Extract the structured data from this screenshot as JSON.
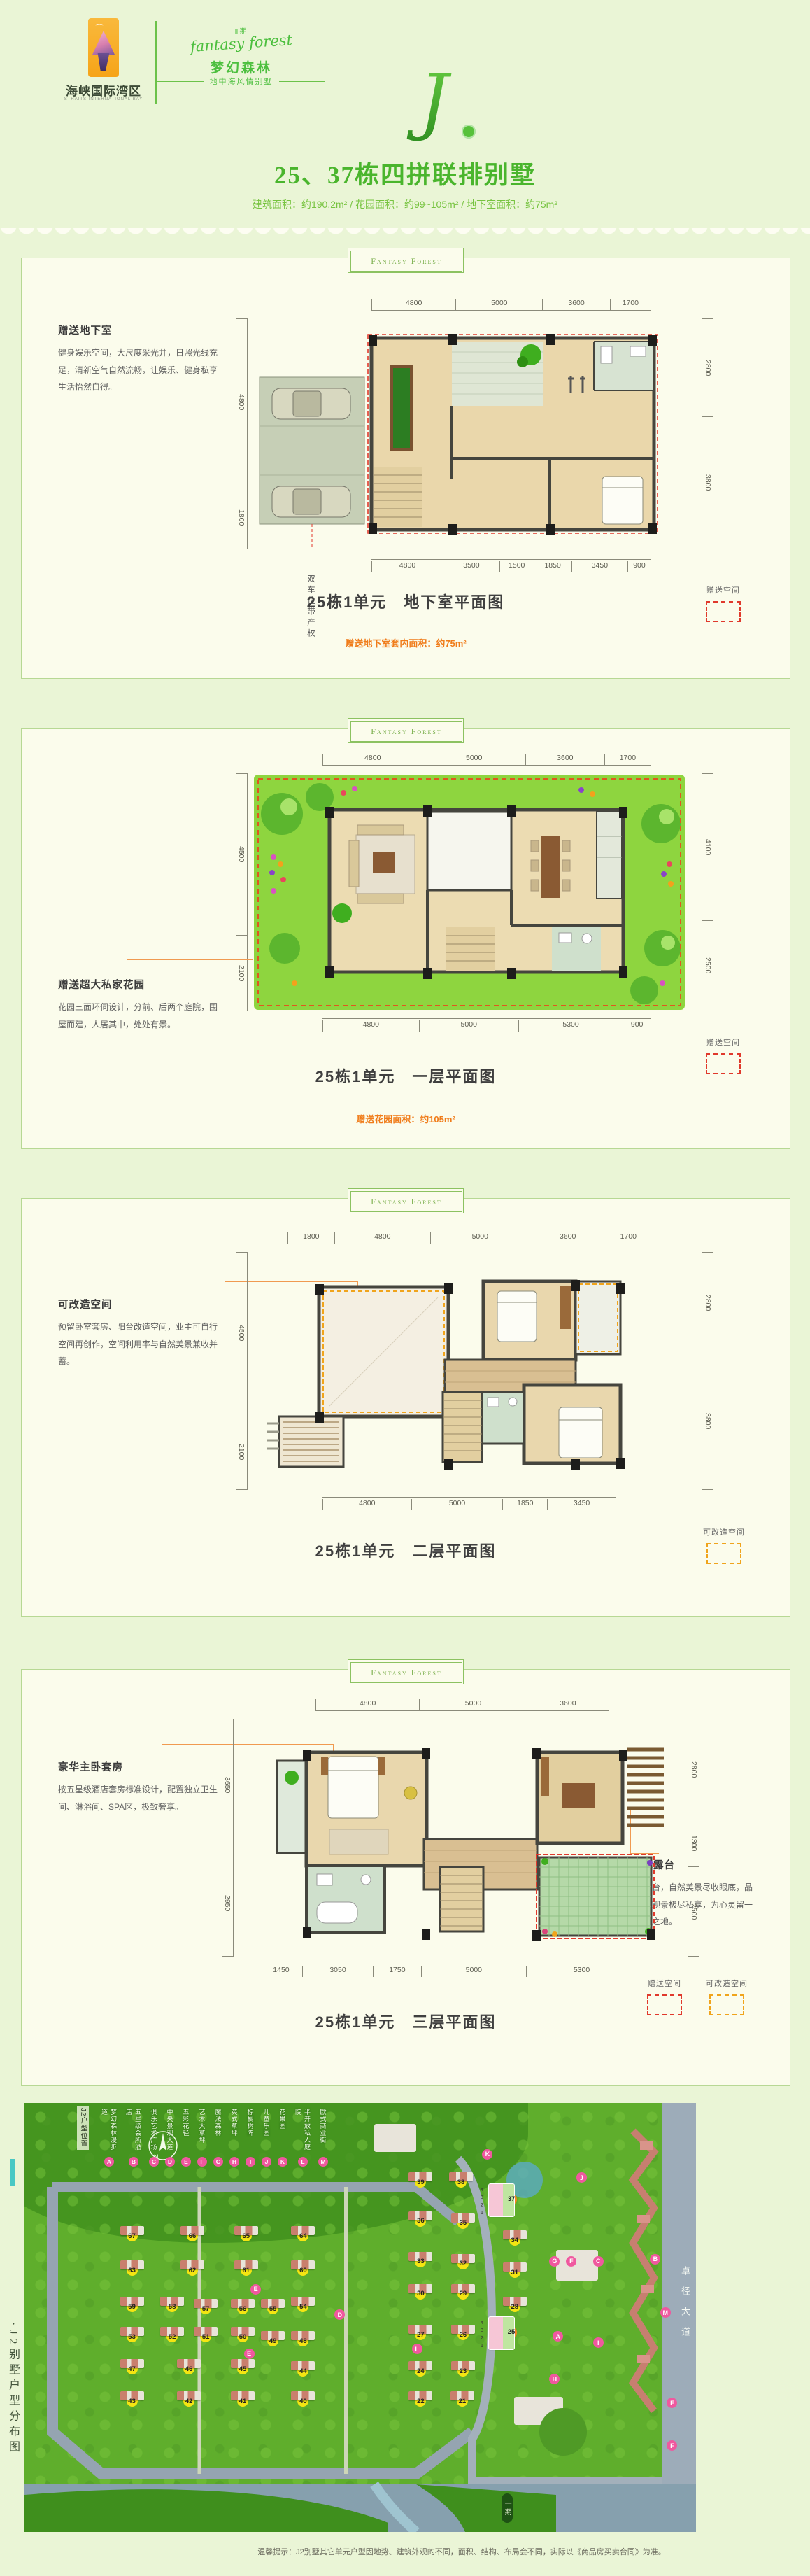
{
  "header": {
    "logo_cn": "海峡国际湾区",
    "logo_en": "STRAITS INTERNATIONAL BAY",
    "phase": "Ⅱ期",
    "brand_script": "fantasy forest",
    "brand_cn": "梦幻森林",
    "brand_tagline": "地中海风情别墅",
    "monogram": "J",
    "title": "25、37栋四拼联排别墅",
    "subtitle": "建筑面积：约190.2m² / 花园面积：约99~105m² / 地下室面积：约75m²"
  },
  "legend_labels": {
    "gift": "赠送空间",
    "remodel": "可改造空间"
  },
  "sections": [
    {
      "badge": "Fantasy Forest",
      "note_title": "赠送地下室",
      "note_body": "健身娱乐空间，大尺度采光井，日照光线充足，清新空气自然流畅，让娱乐、健身私享生活怡然自得。",
      "parking_note": "双车位带产权",
      "caption": "25栋1单元　地下室平面图",
      "highlight": "赠送地下室套内面积：约75m²",
      "dims_top": [
        "4800",
        "5000",
        "3600",
        "1700"
      ],
      "dims_bottom": [
        "4800",
        "3500",
        "1500",
        "1850",
        "3450",
        "900"
      ],
      "dims_left": [
        "4800",
        "1800"
      ],
      "dims_right": [
        "2800",
        "3800"
      ]
    },
    {
      "badge": "Fantasy Forest",
      "note_title": "赠送超大私家花园",
      "note_body": "花园三面环伺设计，分前、后两个庭院，围屋而建，人居其中，处处有景。",
      "caption": "25栋1单元　一层平面图",
      "highlight": "赠送花园面积：约105m²",
      "dims_top": [
        "4800",
        "5000",
        "3600",
        "1700"
      ],
      "dims_bottom": [
        "4800",
        "5000",
        "5300",
        "900"
      ],
      "dims_left": [
        "4500",
        "2100"
      ],
      "dims_right": [
        "4100",
        "2500"
      ]
    },
    {
      "badge": "Fantasy Forest",
      "note_title": "可改造空间",
      "note_body": "预留卧室套房、阳台改造空间，业主可自行空间再创作，空间利用率与自然美景兼收并蓄。",
      "caption": "25栋1单元　二层平面图",
      "dims_top": [
        "1800",
        "4800",
        "5000",
        "3600",
        "1700"
      ],
      "dims_bottom": [
        "4800",
        "5000",
        "1850",
        "3450"
      ],
      "dims_left": [
        "4500",
        "2100"
      ],
      "dims_right": [
        "2800",
        "3800"
      ]
    },
    {
      "badge": "Fantasy Forest",
      "note_title": "豪华主卧套房",
      "note_body": "按五星级酒店套房标准设计，配置独立卫生间、淋浴间、SPA区，极致奢享。",
      "note2_title": "空中景观露台",
      "note2_body": "宽阔花园露台，自然美景尽收眼底，品茗、阅读、观景极尽私享，为心灵留一片清新静修之地。",
      "caption": "25栋1单元　三层平面图",
      "dims_top": [
        "4800",
        "5000",
        "3600"
      ],
      "dims_bottom": [
        "1450",
        "3050",
        "1750",
        "5000",
        "5300"
      ],
      "dims_left": [
        "3650",
        "2950"
      ],
      "dims_right": [
        "2800",
        "1300",
        "2500"
      ]
    }
  ],
  "sitemap": {
    "page_title": "·J2别墅户型分布图",
    "corner_label": "J2户型位置",
    "compass_n": "N",
    "phase_pill": "一期",
    "road_right": "卓径大道",
    "disclaimer": "温馨提示：J2别墅其它单元户型因地势、建筑外观的不同，面积、结构、布局会不同，实际以《商品房买卖合同》为准。",
    "unit_labels": [
      "4",
      "3",
      "2",
      "1"
    ],
    "legend": [
      {
        "letter": "A",
        "label": "梦幻森林漫步道"
      },
      {
        "letter": "B",
        "label": "五星级会所酒店"
      },
      {
        "letter": "C",
        "label": "俱乐艺术广场"
      },
      {
        "letter": "D",
        "label": "中央景观大道"
      },
      {
        "letter": "E",
        "label": "五彩花径"
      },
      {
        "letter": "F",
        "label": "艺术大草坪"
      },
      {
        "letter": "G",
        "label": "魔法森林"
      },
      {
        "letter": "H",
        "label": "英式草坪"
      },
      {
        "letter": "I",
        "label": "棕榈树阵"
      },
      {
        "letter": "J",
        "label": "儿童乐园"
      },
      {
        "letter": "K",
        "label": "花果园"
      },
      {
        "letter": "L",
        "label": "半开放私人庭院"
      },
      {
        "letter": "M",
        "label": "欧式商业街"
      }
    ],
    "buildings": [
      {
        "n": "67",
        "x": 16,
        "y": 31
      },
      {
        "n": "66",
        "x": 25,
        "y": 31
      },
      {
        "n": "65",
        "x": 33,
        "y": 31
      },
      {
        "n": "64",
        "x": 41.5,
        "y": 31
      },
      {
        "n": "63",
        "x": 16,
        "y": 39
      },
      {
        "n": "62",
        "x": 25,
        "y": 39
      },
      {
        "n": "61",
        "x": 33,
        "y": 39
      },
      {
        "n": "60",
        "x": 41.5,
        "y": 39
      },
      {
        "n": "59",
        "x": 16,
        "y": 47.5
      },
      {
        "n": "58",
        "x": 22,
        "y": 47.5
      },
      {
        "n": "57",
        "x": 27,
        "y": 48
      },
      {
        "n": "56",
        "x": 32.5,
        "y": 48
      },
      {
        "n": "55",
        "x": 37,
        "y": 48
      },
      {
        "n": "54",
        "x": 41.5,
        "y": 47.5
      },
      {
        "n": "53",
        "x": 16,
        "y": 54.5
      },
      {
        "n": "52",
        "x": 22,
        "y": 54.5
      },
      {
        "n": "51",
        "x": 27,
        "y": 54.5
      },
      {
        "n": "50",
        "x": 32.5,
        "y": 54.5
      },
      {
        "n": "49",
        "x": 37,
        "y": 55.5
      },
      {
        "n": "48",
        "x": 41.5,
        "y": 55.5
      },
      {
        "n": "47",
        "x": 16,
        "y": 62
      },
      {
        "n": "46",
        "x": 24.5,
        "y": 62
      },
      {
        "n": "45",
        "x": 32.5,
        "y": 62
      },
      {
        "n": "44",
        "x": 41.5,
        "y": 62.5
      },
      {
        "n": "43",
        "x": 16,
        "y": 69.5
      },
      {
        "n": "42",
        "x": 24.5,
        "y": 69.5
      },
      {
        "n": "41",
        "x": 32.5,
        "y": 69.5
      },
      {
        "n": "40",
        "x": 41.5,
        "y": 69.5
      },
      {
        "n": "39",
        "x": 59,
        "y": 18.5
      },
      {
        "n": "38",
        "x": 65,
        "y": 18.5
      },
      {
        "n": "37",
        "x": 72.5,
        "y": 22.5,
        "cls": "hl"
      },
      {
        "n": "36",
        "x": 59,
        "y": 27.5
      },
      {
        "n": "35",
        "x": 65.3,
        "y": 28
      },
      {
        "n": "34",
        "x": 73,
        "y": 32
      },
      {
        "n": "33",
        "x": 59,
        "y": 37
      },
      {
        "n": "32",
        "x": 65.3,
        "y": 37.5
      },
      {
        "n": "31",
        "x": 73,
        "y": 39.5
      },
      {
        "n": "30",
        "x": 59,
        "y": 44.5
      },
      {
        "n": "29",
        "x": 65.3,
        "y": 44.5
      },
      {
        "n": "28",
        "x": 73,
        "y": 47.5
      },
      {
        "n": "27",
        "x": 59,
        "y": 54
      },
      {
        "n": "26",
        "x": 65.3,
        "y": 54
      },
      {
        "n": "25",
        "x": 72.5,
        "y": 53.5,
        "cls": "hl"
      },
      {
        "n": "24",
        "x": 59,
        "y": 62.5
      },
      {
        "n": "23",
        "x": 65.3,
        "y": 62.5
      },
      {
        "n": "22",
        "x": 59,
        "y": 69.5
      },
      {
        "n": "21",
        "x": 65.2,
        "y": 69.5
      }
    ],
    "map_letters": [
      {
        "t": "K",
        "x": 69,
        "y": 12
      },
      {
        "t": "J",
        "x": 83,
        "y": 17.5
      },
      {
        "t": "E",
        "x": 34.5,
        "y": 43.5
      },
      {
        "t": "D",
        "x": 47,
        "y": 49.5
      },
      {
        "t": "E",
        "x": 33.5,
        "y": 58.5
      },
      {
        "t": "L",
        "x": 58.5,
        "y": 57.5
      },
      {
        "t": "G",
        "x": 79,
        "y": 37
      },
      {
        "t": "F",
        "x": 81.5,
        "y": 37
      },
      {
        "t": "C",
        "x": 85.5,
        "y": 37
      },
      {
        "t": "B",
        "x": 94,
        "y": 36.5
      },
      {
        "t": "M",
        "x": 95.5,
        "y": 49
      },
      {
        "t": "A",
        "x": 79.5,
        "y": 54.5
      },
      {
        "t": "I",
        "x": 85.5,
        "y": 56
      },
      {
        "t": "H",
        "x": 79,
        "y": 64.5
      },
      {
        "t": "F",
        "x": 96.5,
        "y": 70
      },
      {
        "t": "F",
        "x": 96.5,
        "y": 80
      }
    ]
  }
}
